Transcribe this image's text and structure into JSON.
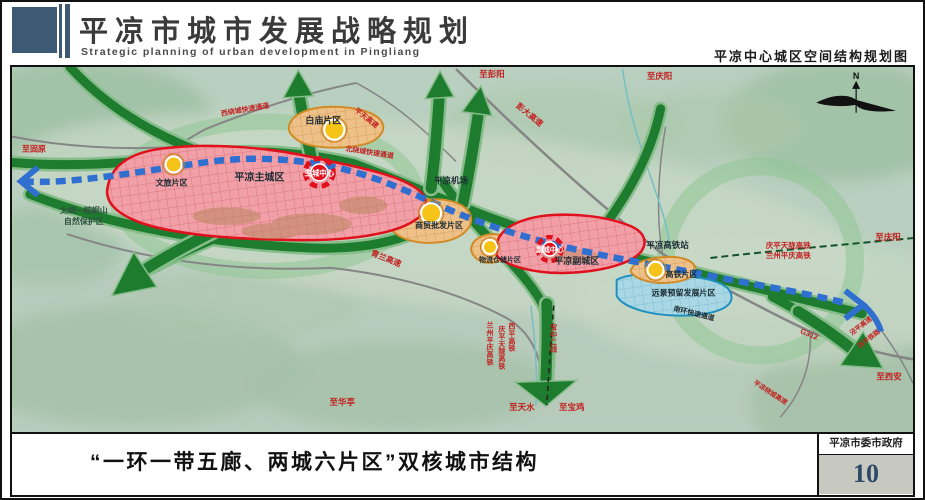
{
  "header": {
    "title": "平凉市城市发展战略规划",
    "subtitle": "Strategic planning of urban development in Pingliang",
    "right_caption": "平凉中心城区空间结构规划图"
  },
  "footer": {
    "caption": "“一环一带五廊、两城六片区”双核城市结构",
    "publisher": "平凉市委市政府",
    "page_number": "10"
  },
  "map": {
    "compass": "N",
    "labels": [
      {
        "id": "baimiao",
        "text": "白庙片区",
        "x": 312,
        "y": 57,
        "size": 9,
        "color": "dark"
      },
      {
        "id": "wenlv",
        "text": "文旅片区",
        "x": 160,
        "y": 119,
        "size": 8,
        "color": "dark"
      },
      {
        "id": "zhucheng",
        "text": "平凉主城区",
        "x": 248,
        "y": 114,
        "size": 10,
        "color": "dark"
      },
      {
        "id": "zhucheng-center",
        "text": "主城中心",
        "x": 308,
        "y": 109,
        "size": 7.5,
        "color": "white"
      },
      {
        "id": "shangmao",
        "text": "商贸批发片区",
        "x": 428,
        "y": 162,
        "size": 8,
        "color": "dark"
      },
      {
        "id": "wuliu",
        "text": "物流仓储片区",
        "x": 489,
        "y": 196,
        "size": 7,
        "color": "dark"
      },
      {
        "id": "fucheng-center",
        "text": "副城中心",
        "x": 539,
        "y": 186,
        "size": 7,
        "color": "white"
      },
      {
        "id": "fucheng",
        "text": "平凉副城区",
        "x": 566,
        "y": 198,
        "size": 9,
        "color": "dark"
      },
      {
        "id": "gaotie-pianqu",
        "text": "高铁片区",
        "x": 671,
        "y": 211,
        "size": 8,
        "color": "dark"
      },
      {
        "id": "yuanjing",
        "text": "远景预留发展片区",
        "x": 673,
        "y": 230,
        "size": 8,
        "color": "dark"
      },
      {
        "id": "jichang",
        "text": "平凉机场",
        "x": 440,
        "y": 117,
        "size": 8.5,
        "color": "dark"
      },
      {
        "id": "gaotiezhan",
        "text": "平凉高铁站",
        "x": 657,
        "y": 182,
        "size": 8.5,
        "color": "dark"
      },
      {
        "id": "taitong",
        "text": "太统—崆峒山",
        "x": 72,
        "y": 147,
        "size": 8,
        "color": "green"
      },
      {
        "id": "baohuqu",
        "text": "自然保护区",
        "x": 72,
        "y": 158,
        "size": 8,
        "color": "green"
      },
      {
        "id": "nanhuan",
        "text": "南环快速通道",
        "x": 683,
        "y": 250,
        "size": 7,
        "color": "dark",
        "rot": 14
      },
      {
        "id": "zhi-pengyang",
        "text": "至彭阳",
        "x": 481,
        "y": 10,
        "size": 8.5,
        "color": "red"
      },
      {
        "id": "zhi-qingyang-n",
        "text": "至庆阳",
        "x": 649,
        "y": 12,
        "size": 8.5,
        "color": "red"
      },
      {
        "id": "pengda-gaosu",
        "text": "彭大高速",
        "x": 517,
        "y": 50,
        "size": 8,
        "color": "red",
        "rot": 40
      },
      {
        "id": "pingtian-gaosu",
        "text": "平天高速",
        "x": 354,
        "y": 53,
        "size": 7,
        "color": "red",
        "rot": 38
      },
      {
        "id": "xiraocheng",
        "text": "西绕城快速通道",
        "x": 234,
        "y": 45,
        "size": 7,
        "color": "red",
        "rot": -10
      },
      {
        "id": "beiraocheng",
        "text": "北绕城快速通道",
        "x": 358,
        "y": 88,
        "size": 7,
        "color": "red",
        "rot": 9
      },
      {
        "id": "qinglan-gaosu",
        "text": "青兰高速",
        "x": 374,
        "y": 195,
        "size": 8,
        "color": "red",
        "rot": 22
      },
      {
        "id": "zhi-guyuan",
        "text": "至固原",
        "x": 22,
        "y": 85,
        "size": 8,
        "color": "red"
      },
      {
        "id": "qptl-gaotie",
        "text": "庆平天陇高铁",
        "x": 778,
        "y": 182,
        "size": 7.5,
        "color": "red"
      },
      {
        "id": "lzpq-gaotie",
        "text": "兰州平庆高铁",
        "x": 778,
        "y": 192,
        "size": 7.5,
        "color": "red"
      },
      {
        "id": "zhi-qingyang-e",
        "text": "至庆阳",
        "x": 878,
        "y": 174,
        "size": 8.5,
        "color": "red"
      },
      {
        "id": "g312",
        "text": "G312",
        "x": 798,
        "y": 271,
        "size": 7.5,
        "color": "red",
        "rot": 22
      },
      {
        "id": "jingping-gaosu",
        "text": "泾平高速",
        "x": 852,
        "y": 262,
        "size": 6.5,
        "color": "red",
        "rot": -38
      },
      {
        "id": "xiping-tielu",
        "text": "西平铁路",
        "x": 860,
        "y": 275,
        "size": 6.5,
        "color": "red",
        "rot": -38
      },
      {
        "id": "zhi-xian",
        "text": "至西安",
        "x": 879,
        "y": 314,
        "size": 8.5,
        "color": "red"
      },
      {
        "id": "raocheng-gaosu",
        "text": "平凉绕城高速",
        "x": 759,
        "y": 329,
        "size": 6.5,
        "color": "red",
        "rot": 33
      },
      {
        "id": "zhi-huating",
        "text": "至华亭",
        "x": 331,
        "y": 340,
        "size": 8.5,
        "color": "red"
      },
      {
        "id": "zhi-tianshui",
        "text": "至天水",
        "x": 511,
        "y": 345,
        "size": 8.5,
        "color": "red"
      },
      {
        "id": "zhi-baoji",
        "text": "至宝鸡",
        "x": 561,
        "y": 345,
        "size": 8.5,
        "color": "red"
      },
      {
        "id": "v-lzpq",
        "text": "兰州平庆高铁",
        "x": 479,
        "y": 262,
        "size": 7,
        "color": "red",
        "vertical": true
      },
      {
        "id": "v-qptl",
        "text": "庆平天陇高铁",
        "x": 491,
        "y": 266,
        "size": 7,
        "color": "red",
        "vertical": true
      },
      {
        "id": "v-xiping",
        "text": "西平高铁",
        "x": 501,
        "y": 263,
        "size": 7,
        "color": "red",
        "vertical": true
      },
      {
        "id": "v-baozhong",
        "text": "宝中二线",
        "x": 543,
        "y": 264,
        "size": 7,
        "color": "red",
        "vertical": true
      }
    ]
  },
  "colors": {
    "header_blue": "#3d5a75",
    "map_background": "#b9cfbf",
    "corridor_green": "#1e7c2e",
    "axis_blue": "#2e6fd0",
    "zone_red": "#e0101c",
    "zone_orange": "#d18a25",
    "zone_blue": "#2090c0",
    "node_yellow": "#f6c418",
    "page_number_blue": "#2c4a68",
    "label_colors": {
      "red": "#c21f1f",
      "dark": "#1c2b33",
      "white": "#ffffff",
      "green": "#2f5140"
    }
  }
}
